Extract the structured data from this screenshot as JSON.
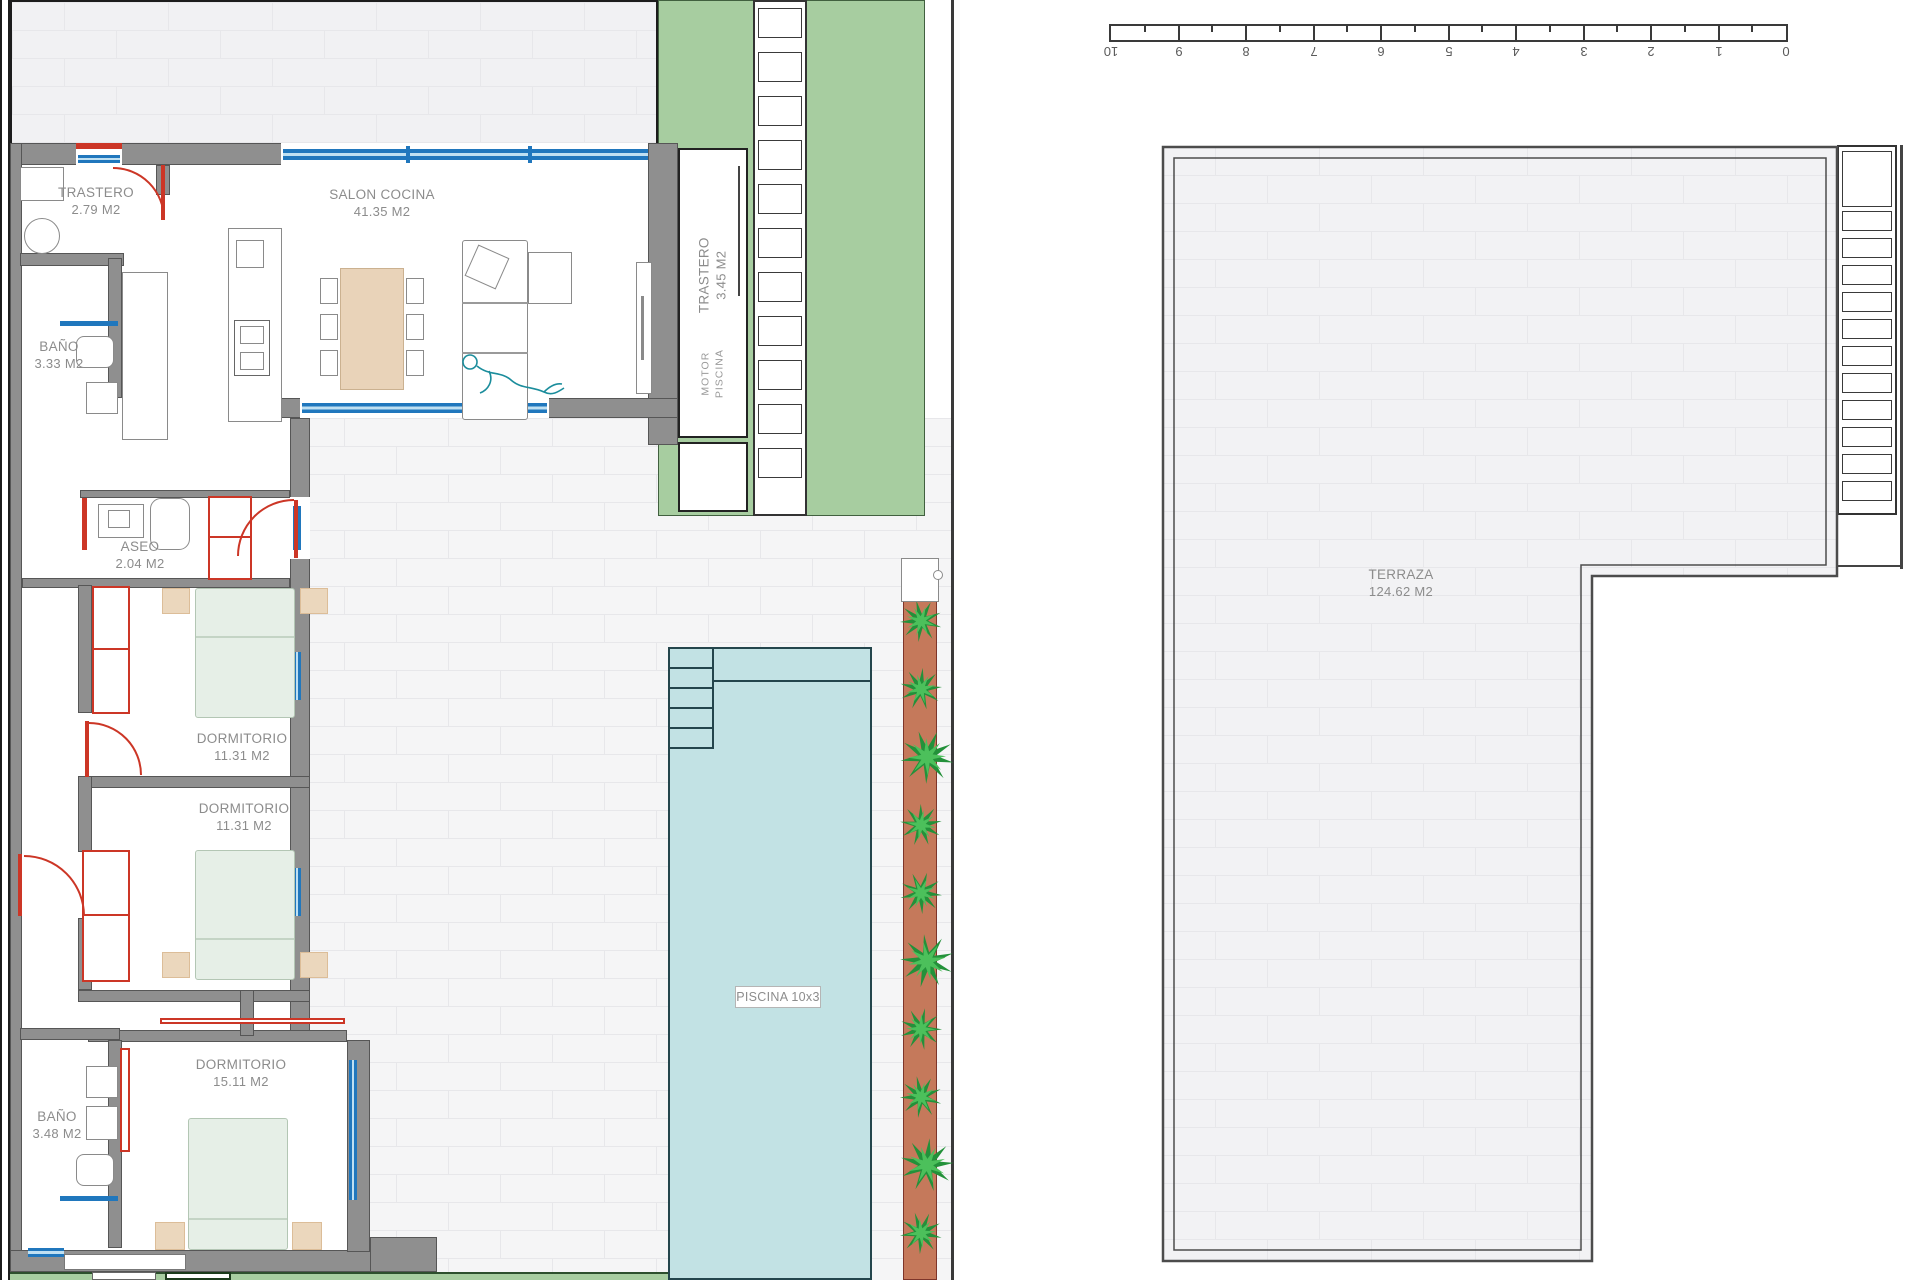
{
  "plan": {
    "unit_left": {
      "rooms": {
        "trastero1": {
          "name": "TRASTERO",
          "area": "2.79 M2"
        },
        "salon": {
          "name": "SALON COCINA",
          "area": "41.35 M2"
        },
        "bano1": {
          "name": "BAÑO",
          "area": "3.33 M2"
        },
        "aseo": {
          "name": "ASEO",
          "area": "2.04 M2"
        },
        "dormitorio1": {
          "name": "DORMITORIO",
          "area": "11.31 M2"
        },
        "dormitorio2": {
          "name": "DORMITORIO",
          "area": "11.31 M2"
        },
        "dormitorio3": {
          "name": "DORMITORIO",
          "area": "15.11 M2"
        },
        "bano2": {
          "name": "BAÑO",
          "area": "3.48 M2"
        },
        "trastero2": {
          "name": "TRASTERO",
          "area": "3.45 M2"
        },
        "motor": {
          "name": "MOTOR PISCINA"
        }
      },
      "pool": {
        "label": "PISCINA 10x3"
      }
    },
    "unit_right": {
      "terraza": {
        "name": "TERRAZA",
        "area": "124.62 M2"
      }
    },
    "scale_bar": {
      "labels": [
        "10",
        "9",
        "8",
        "7",
        "6",
        "5",
        "4",
        "3",
        "2",
        "1",
        "0"
      ]
    },
    "colors": {
      "garden": "#a7cda0",
      "pool": "#c2e2e4",
      "planter": "#c5795b",
      "wall": "#8f8f8f",
      "window": "#2077bd",
      "door": "#cc3626",
      "bed": "#e6efe7",
      "pillow": "#ebd7bd",
      "table": "#e9d3b9"
    }
  }
}
